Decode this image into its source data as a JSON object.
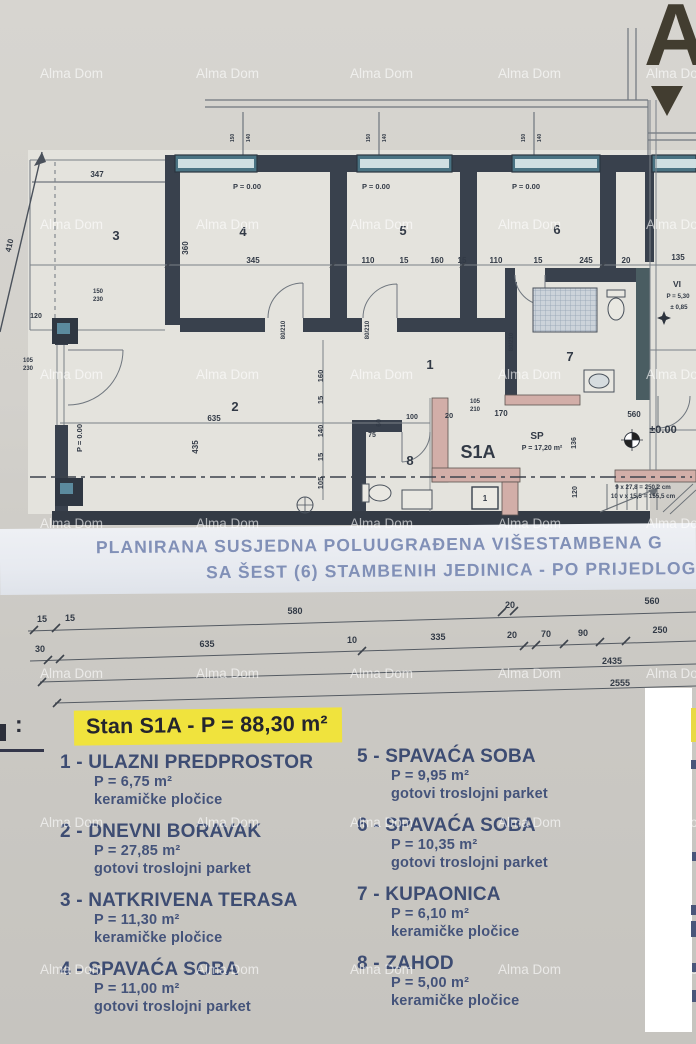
{
  "watermark": {
    "text": "Alma Dom",
    "rows": [
      66,
      217,
      367,
      516,
      666,
      815,
      962
    ],
    "cols": [
      40,
      196,
      350,
      498,
      646
    ]
  },
  "corner": {
    "letter": "A"
  },
  "caption": {
    "line1": "PLANIRANA SUSJEDNA POLUUGRAĐENA VIŠESTAMBENA G",
    "line2": "SA ŠEST (6) STAMBENIH JEDINICA - PO PRIJEDLOGU PA"
  },
  "plan": {
    "labels": [
      {
        "t": "4",
        "x": 243,
        "y": 236,
        "s": 13,
        "b": 1
      },
      {
        "t": "5",
        "x": 403,
        "y": 235,
        "s": 13,
        "b": 1
      },
      {
        "t": "6",
        "x": 557,
        "y": 234,
        "s": 13,
        "b": 1
      },
      {
        "t": "3",
        "x": 116,
        "y": 240,
        "s": 13,
        "b": 1
      },
      {
        "t": "1",
        "x": 430,
        "y": 369,
        "s": 13,
        "b": 1
      },
      {
        "t": "2",
        "x": 235,
        "y": 411,
        "s": 13,
        "b": 1
      },
      {
        "t": "7",
        "x": 570,
        "y": 361,
        "s": 13,
        "b": 1
      },
      {
        "t": "8",
        "x": 410,
        "y": 465,
        "s": 13,
        "b": 1
      },
      {
        "t": "P = 0.00",
        "x": 247,
        "y": 189,
        "s": 7.5
      },
      {
        "t": "P = 0.00",
        "x": 376,
        "y": 189,
        "s": 7.5
      },
      {
        "t": "P = 0.00",
        "x": 526,
        "y": 189,
        "s": 7.5
      },
      {
        "t": "P = 0.00",
        "x": 82,
        "y": 438,
        "r": -90,
        "s": 7.5
      },
      {
        "t": "347",
        "x": 97,
        "y": 177,
        "s": 8
      },
      {
        "t": "410",
        "x": 12,
        "y": 246,
        "r": -77,
        "s": 8
      },
      {
        "t": "360",
        "x": 188,
        "y": 248,
        "r": -90,
        "s": 8
      },
      {
        "t": "345",
        "x": 253,
        "y": 263,
        "s": 8
      },
      {
        "t": "110",
        "x": 368,
        "y": 263,
        "s": 8
      },
      {
        "t": "15",
        "x": 404,
        "y": 263,
        "s": 8
      },
      {
        "t": "160",
        "x": 437,
        "y": 263,
        "s": 8
      },
      {
        "t": "15",
        "x": 462,
        "y": 263,
        "s": 8
      },
      {
        "t": "110",
        "x": 496,
        "y": 263,
        "s": 8
      },
      {
        "t": "15",
        "x": 538,
        "y": 263,
        "s": 8
      },
      {
        "t": "245",
        "x": 586,
        "y": 263,
        "s": 8
      },
      {
        "t": "20",
        "x": 626,
        "y": 263,
        "s": 8
      },
      {
        "t": "135",
        "x": 678,
        "y": 260,
        "s": 8
      },
      {
        "t": "635",
        "x": 214,
        "y": 421,
        "s": 8
      },
      {
        "t": "435",
        "x": 198,
        "y": 447,
        "r": -90,
        "s": 8
      },
      {
        "t": "160",
        "x": 323,
        "y": 376,
        "r": -90,
        "s": 7.5
      },
      {
        "t": "15",
        "x": 323,
        "y": 400,
        "r": -90,
        "s": 7.5
      },
      {
        "t": "140",
        "x": 323,
        "y": 431,
        "r": -90,
        "s": 7.5
      },
      {
        "t": "15",
        "x": 323,
        "y": 457,
        "r": -90,
        "s": 7.5
      },
      {
        "t": "105",
        "x": 323,
        "y": 483,
        "r": -90,
        "s": 7.5
      },
      {
        "t": "80/210",
        "x": 285,
        "y": 330,
        "r": -90,
        "s": 6
      },
      {
        "t": "80/210",
        "x": 369,
        "y": 330,
        "r": -90,
        "s": 6
      },
      {
        "t": "80/210",
        "x": 513,
        "y": 342,
        "r": -90,
        "s": 6
      },
      {
        "t": "100",
        "x": 412,
        "y": 419,
        "s": 7
      },
      {
        "t": "60",
        "x": 381,
        "y": 423,
        "r": -90,
        "s": 7
      },
      {
        "t": "75",
        "x": 372,
        "y": 437,
        "s": 7
      },
      {
        "t": "20",
        "x": 449,
        "y": 418,
        "s": 7.5
      },
      {
        "t": "170",
        "x": 501,
        "y": 416,
        "s": 8
      },
      {
        "t": "105",
        "x": 475,
        "y": 403,
        "s": 6
      },
      {
        "t": "210",
        "x": 475,
        "y": 411,
        "s": 6
      },
      {
        "t": "S1A",
        "x": 478,
        "y": 458,
        "s": 18,
        "b": 1
      },
      {
        "t": "SP",
        "x": 537,
        "y": 439,
        "s": 10,
        "b": 1
      },
      {
        "t": "P = 17,20 m²",
        "x": 542,
        "y": 450,
        "s": 7
      },
      {
        "t": "136",
        "x": 576,
        "y": 443,
        "r": -90,
        "s": 7
      },
      {
        "t": "±0.00",
        "x": 663,
        "y": 433,
        "s": 11,
        "b": 1
      },
      {
        "t": "560",
        "x": 634,
        "y": 417,
        "s": 8
      },
      {
        "t": "9 x 27,8 = 250,2 cm",
        "x": 643,
        "y": 489,
        "s": 6.2
      },
      {
        "t": "10 v x 15,5 = 155,5 cm",
        "x": 643,
        "y": 498,
        "s": 6.2
      },
      {
        "t": "120",
        "x": 577,
        "y": 492,
        "r": -90,
        "s": 7
      },
      {
        "t": "1",
        "x": 485,
        "y": 501,
        "s": 8,
        "b": 1
      },
      {
        "t": "VI",
        "x": 677,
        "y": 287,
        "s": 8.5,
        "b": 1
      },
      {
        "t": "P = 5,30",
        "x": 678,
        "y": 298,
        "s": 6.2
      },
      {
        "t": "± 0,85",
        "x": 679,
        "y": 309,
        "s": 6.2
      },
      {
        "t": "150",
        "x": 98,
        "y": 293,
        "s": 6
      },
      {
        "t": "230",
        "x": 98,
        "y": 301,
        "s": 6
      },
      {
        "t": "105",
        "x": 28,
        "y": 362,
        "s": 6
      },
      {
        "t": "230",
        "x": 28,
        "y": 370,
        "s": 6
      },
      {
        "t": "120",
        "x": 36,
        "y": 318,
        "s": 7
      },
      {
        "t": "150",
        "x": 234,
        "y": 138,
        "r": -90,
        "s": 5
      },
      {
        "t": "140",
        "x": 250,
        "y": 138,
        "r": -90,
        "s": 5
      },
      {
        "t": "150",
        "x": 370,
        "y": 138,
        "r": -90,
        "s": 5
      },
      {
        "t": "140",
        "x": 386,
        "y": 138,
        "r": -90,
        "s": 5
      },
      {
        "t": "150",
        "x": 525,
        "y": 138,
        "r": -90,
        "s": 5
      },
      {
        "t": "140",
        "x": 541,
        "y": 138,
        "r": -90,
        "s": 5
      },
      {
        "t": "15",
        "x": 42,
        "y": 622,
        "s": 9,
        "b": 1
      },
      {
        "t": "15",
        "x": 70,
        "y": 621,
        "s": 9,
        "b": 1
      },
      {
        "t": "580",
        "x": 295,
        "y": 614,
        "s": 9,
        "b": 1
      },
      {
        "t": "20",
        "x": 510,
        "y": 608,
        "s": 9,
        "b": 1
      },
      {
        "t": "560",
        "x": 652,
        "y": 604,
        "s": 9,
        "b": 1
      },
      {
        "t": "30",
        "x": 40,
        "y": 652,
        "s": 9,
        "b": 1
      },
      {
        "t": "635",
        "x": 207,
        "y": 647,
        "s": 9,
        "b": 1
      },
      {
        "t": "10",
        "x": 352,
        "y": 643,
        "s": 9,
        "b": 1
      },
      {
        "t": "335",
        "x": 438,
        "y": 640,
        "s": 9,
        "b": 1
      },
      {
        "t": "20",
        "x": 512,
        "y": 638,
        "s": 9,
        "b": 1
      },
      {
        "t": "70",
        "x": 546,
        "y": 637,
        "s": 9,
        "b": 1
      },
      {
        "t": "90",
        "x": 583,
        "y": 636,
        "s": 9,
        "b": 1
      },
      {
        "t": "250",
        "x": 660,
        "y": 633,
        "s": 9,
        "b": 1
      },
      {
        "t": "2435",
        "x": 612,
        "y": 664,
        "s": 9,
        "b": 1
      },
      {
        "t": "2555",
        "x": 620,
        "y": 686,
        "s": 9,
        "b": 1
      }
    ]
  },
  "legend": {
    "fragment": ":",
    "title": "Stan S1A  -  P = 88,30 m²",
    "items": [
      {
        "col": "left",
        "name": "1 - ULAZNI PREDPROSTOR",
        "area": "P = 6,75 m²",
        "floor": "keramičke pločice"
      },
      {
        "col": "left",
        "name": "2 - DNEVNI BORAVAK",
        "area": "P = 27,85 m²",
        "floor": "gotovi troslojni parket"
      },
      {
        "col": "left",
        "name": "3 - NATKRIVENA TERASA",
        "area": "P = 11,30 m²",
        "floor": "keramičke pločice"
      },
      {
        "col": "left",
        "name": "4 - SPAVAĆA SOBA",
        "area": "P = 11,00 m²",
        "floor": "gotovi troslojni parket"
      },
      {
        "col": "right",
        "name": "5 - SPAVAĆA SOBA",
        "area": "P = 9,95 m²",
        "floor": "gotovi troslojni parket"
      },
      {
        "col": "right",
        "name": "6 - SPAVAĆA SOBA",
        "area": "P = 10,35 m²",
        "floor": "gotovi troslojni parket"
      },
      {
        "col": "right",
        "name": "7 - KUPAONICA",
        "area": "P = 6,10 m²",
        "floor": "keramičke pločice"
      },
      {
        "col": "right",
        "name": "8 - ZAHOD",
        "area": "P = 5,00 m²",
        "floor": "keramičke pločice"
      }
    ]
  }
}
